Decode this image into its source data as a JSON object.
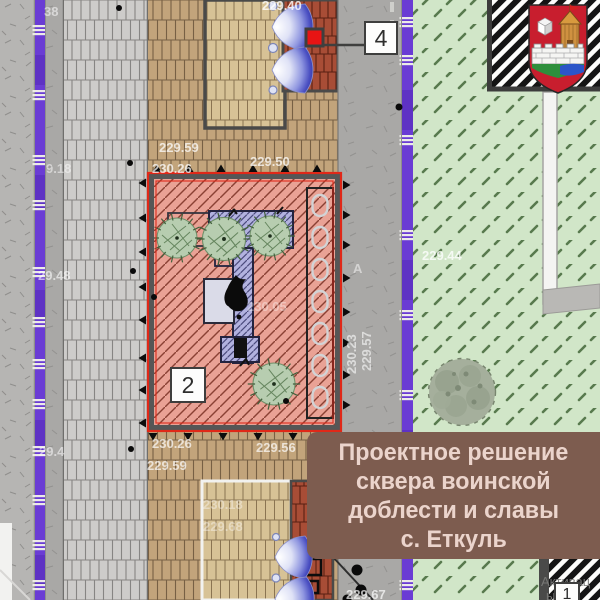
{
  "banner": {
    "lines": [
      "Проектное решение",
      "сквера воинской",
      "доблести и славы",
      "с. Еткуль"
    ]
  },
  "callouts": {
    "c1": "1",
    "c2": "2",
    "c4": "4"
  },
  "labels": {
    "e240": "229.40",
    "e259a": "229.59",
    "e2026a": "230.26",
    "e250": "229.50",
    "e244": "229.44",
    "e257": "229.57",
    "e2023": "230.23",
    "e2005": "230.05",
    "e2026b": "230.26",
    "e259b": "229.59",
    "e256": "229.56",
    "e38": "38",
    "e918": "9.18",
    "e2948": "29.48",
    "e294": "29.4",
    "e267": "229.67",
    "e2018": "230.18",
    "e268": "229.68",
    "roadA": "А"
  },
  "watermark": {
    "line1": "Активац",
    "line2": "ы ут"
  },
  "colors": {
    "banner_bg": "#7d5c4f",
    "banner_text": "#ebd4cc",
    "square_fill": "#e9a295",
    "square_hatch": "#8a4134",
    "boundary_red": "#e02818",
    "utility_purple": "#6a3cd4",
    "lawn_green": "#d1e6c8",
    "monument_blue": "#b2b2df",
    "marker_red": "#e81414",
    "flame_black": "#0b0b0b"
  }
}
